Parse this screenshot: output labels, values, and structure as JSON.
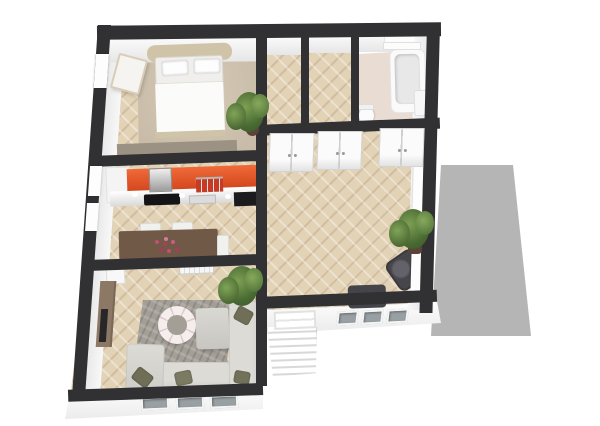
{
  "scene": {
    "type": "3d-floor-plan-render",
    "view": "isometric-top-down",
    "width_px": 600,
    "height_px": 426,
    "visible_text": "none"
  },
  "colors": {
    "bg": "#ffffff",
    "wall": "#313133",
    "parquet": "#e2d2b6",
    "carpet": "#d5cab7",
    "bathFloor": "#e9dcd3",
    "kitchenOrange": "#e8572c",
    "kitchenOrangeDark": "#d1441c",
    "counter": "#f4f4f4",
    "applianceBlack": "#141416",
    "steel": "#a8a8a8",
    "tableWood": "#705947",
    "sideboardWood": "#8d7866",
    "tvBlack": "#27272a",
    "sofa": "#dddbd6",
    "rug": "#a39e96",
    "pillowOlive": "#6f6e57",
    "armchairDark": "#47464b",
    "plantGreen": "#4a6b33",
    "plantDark": "#3a5527",
    "potBrown": "#5a4438",
    "terrace": "#b5b5b5",
    "glass": "#98a0a3",
    "bedFrame": "#cfc3a8",
    "dresserTaupe": "#9c9283",
    "flowerPink": "#c24f74"
  },
  "rooms": [
    {
      "id": "bedroom",
      "floor_finish": "carpet-over-parquet",
      "furniture": [
        "double-bed",
        "two-pillows",
        "bedside-bench",
        "potted-plant",
        "low-dresser",
        "west-window"
      ]
    },
    {
      "id": "hallway-left",
      "floor_finish": "herringbone-parquet",
      "furniture": []
    },
    {
      "id": "hallway-right",
      "floor_finish": "herringbone-parquet",
      "furniture": []
    },
    {
      "id": "bathroom",
      "floor_finish": "tile",
      "furniture": [
        "bathtub",
        "toilet",
        "pedestal-sink",
        "towel-rail"
      ]
    },
    {
      "id": "kitchen-dining",
      "floor_finish": "herringbone-parquet",
      "furniture": [
        "orange-kitchen-counter",
        "range-hood",
        "cooktop",
        "red-shelf",
        "black-oven",
        "dining-table",
        "three-chairs",
        "flower-centerpiece",
        "two-west-windows"
      ]
    },
    {
      "id": "living-room",
      "floor_finish": "herringbone-parquet",
      "furniture": [
        "corner-sofa",
        "light-armchair",
        "ottoman",
        "area-rug",
        "round-wreath-decor",
        "sideboard",
        "tv",
        "radiator",
        "white-cabinet",
        "potted-plant",
        "four-pillows"
      ]
    },
    {
      "id": "great-room",
      "floor_finish": "herringbone-parquet",
      "furniture": [
        "double-door-1",
        "double-door-2",
        "double-door-3",
        "dark-armchair-1",
        "dark-armchair-2",
        "potted-plant",
        "two-east-windows",
        "slippers"
      ]
    },
    {
      "id": "terrace",
      "floor_finish": "concrete",
      "furniture": []
    },
    {
      "id": "entry",
      "floor_finish": "exterior",
      "furniture": [
        "exterior-stairs",
        "stair-railing",
        "three-south-windows-great-room",
        "three-south-windows-living-room"
      ]
    }
  ]
}
